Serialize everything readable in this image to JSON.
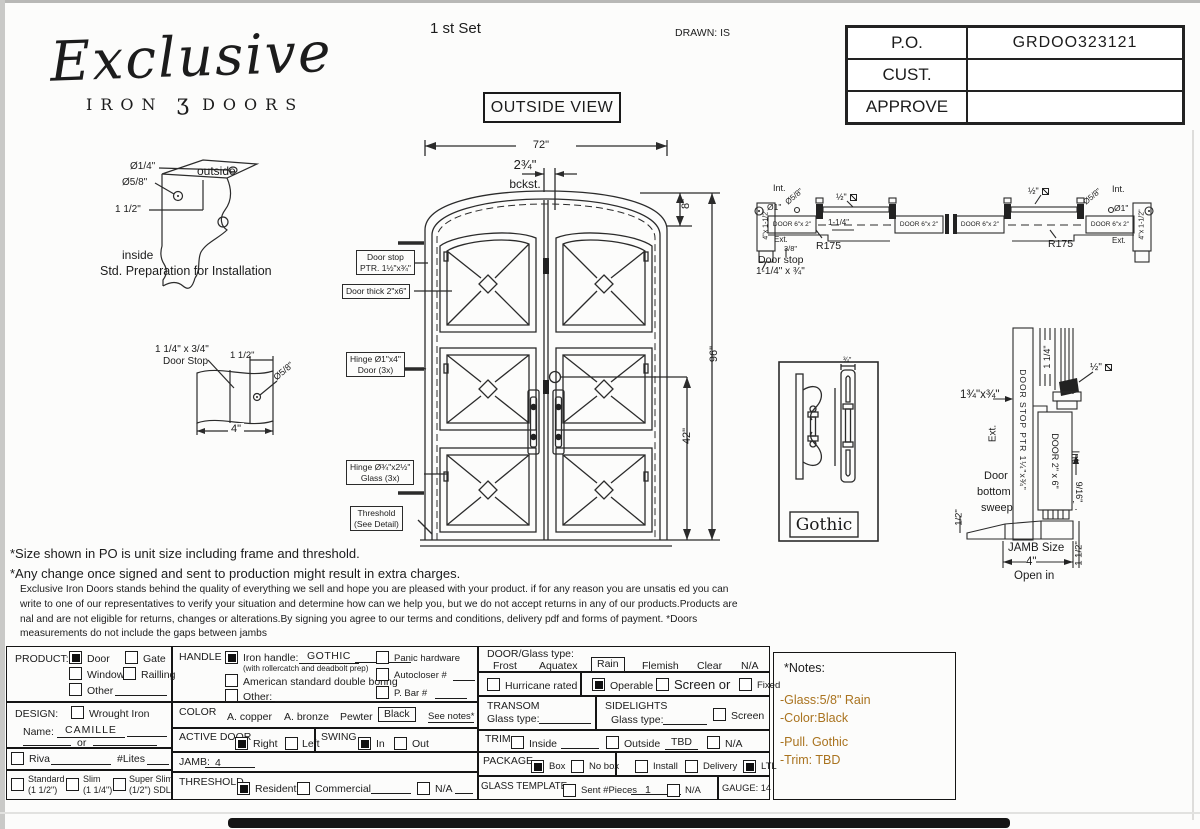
{
  "page": {
    "set_label": "1 st Set",
    "drawn_label": "DRAWN: IS",
    "outside_view": "OUTSIDE VIEW"
  },
  "logo": {
    "script": "Exclusive",
    "iron": "IRON",
    "amp": "ʒ",
    "doors": "DOORS"
  },
  "po_table": {
    "rows": [
      {
        "label": "P.O.",
        "value": "GRDOO323121"
      },
      {
        "label": "CUST.",
        "value": ""
      },
      {
        "label": "APPROVE",
        "value": ""
      }
    ]
  },
  "corner_detail": {
    "dia_quarter": "Ø1/4\"",
    "dia_fiveeighths": "Ø5/8\"",
    "dim_one_half": "1 1/2\"",
    "outside": "outside",
    "inside": "inside",
    "caption": "Std. Preparation for Installation"
  },
  "doorstop_detail": {
    "size": "1 1/4\" x 3/4\"",
    "name": "Door Stop",
    "dim_one_half": "1 1/2\"",
    "dia": "Ø5/8\"",
    "width": "4\""
  },
  "door": {
    "dim_width": "72\"",
    "backset": "2¾\"",
    "backset_sub": "bckst.",
    "dim_top": "8\"",
    "dim_height": "96\"",
    "dim_handle": "42\"",
    "lbl_stop_1": "Door stop",
    "lbl_stop_2": "PTR. 1½\"x¾\"",
    "lbl_thick": "Door thick 2\"x6\"",
    "lbl_hinge_door_1": "Hinge Ø1\"x4\"",
    "lbl_hinge_door_2": "Door (3x)",
    "lbl_hinge_glass_1": "Hinge Ø¾\"x2½\"",
    "lbl_hinge_glass_2": "Glass (3x)",
    "lbl_threshold_1": "Threshold",
    "lbl_threshold_2": "(See Detail)"
  },
  "plan": {
    "int_l": "Int.",
    "dia1_l": "Ø1\"",
    "dia58_l": "Ø5/8\"",
    "jamb_box": "4\"x 1-1/2\"",
    "door_box": "DOOR 6\"x 2\"",
    "half": "½\"",
    "dim_114": "1-1/4\"",
    "ext_l": "Ext.",
    "dim_38": "3/8\"",
    "r175": "R175",
    "stop_1": "Door stop",
    "stop_2": "1-1/4\" x ¾\"",
    "dia58_r": "Ø5/8\"",
    "int_r": "Int.",
    "dia1_r": "Ø1\"",
    "ext_r": "Ext."
  },
  "handle_box": {
    "caption": "Gothic",
    "dim": "¾\""
  },
  "jamb_section": {
    "dim_114": "1 1/4\"",
    "half": "½\"",
    "dim_134": "1¾\"x¾\"",
    "strip": "DOOR STOP PTR 1¼\"x¾\"",
    "ext": "Ext.",
    "door_box": "DOOR 2\" x 6\"",
    "int": "Int.",
    "dim_916": "9/16\"",
    "sweep_1": "Door",
    "sweep_2": "bottom",
    "sweep_3": "sweep",
    "dim_half": "1/2\"",
    "jamb_1": "JAMB Size",
    "jamb_2": "4\"",
    "jamb_3": "Open in",
    "dim_1half": "1 1/2\""
  },
  "disclaimer": {
    "line1": "*Size shown in PO is unit size including frame and threshold.",
    "line2": "*Any change once signed and sent to production might result in extra charges.",
    "body": "Exclusive Iron Doors stands behind the quality of everything we sell and hope you are pleased with your product. if for any reason you are unsatis ed you can write to one of our representatives to verify your situation and determine how can we help you, but we do not accept returns in any of our products.Products are nal and are not eligible for returns, changes or alterations.By signing you agree to our terms and conditions, delivery pdf and forms of payment. *Doors measurements do not include the gaps between jambs"
  },
  "form": {
    "product": {
      "label": "PRODUCT:",
      "door": "Door",
      "door_c": true,
      "gate": "Gate",
      "gate_c": false,
      "window": "Window",
      "window_c": false,
      "railing": "Railling",
      "railing_c": false,
      "other": "Other",
      "other_c": false
    },
    "handle": {
      "label": "HANDLE",
      "iron": "Iron handle:",
      "iron_val": "GOTHIC",
      "iron_c": true,
      "iron_sub": "(with rollercatch and deadbolt prep)",
      "american": "American standard double boring",
      "american_c": false,
      "other": "Other:",
      "other_c": false,
      "panic": "Panic hardware",
      "panic_c": false,
      "autocloser": "Autocloser #",
      "autocloser_c": false,
      "pbar": "P. Bar #",
      "pbar_c": false
    },
    "color": {
      "label": "COLOR",
      "copper": "A. copper",
      "bronze": "A. bronze",
      "pewter": "Pewter",
      "selected": "Black",
      "see_notes": "See notes*"
    },
    "design": {
      "label": "DESIGN:",
      "wrought": "Wrought Iron",
      "wrought_c": false,
      "name_label": "Name:",
      "name_value": "CAMILLE",
      "or": "or"
    },
    "riva": {
      "label": "Riva",
      "lites": "#Lites",
      "riva_c": false
    },
    "grid": {
      "standard": "Standard",
      "standard_sub": "(1 1/2\")",
      "standard_c": false,
      "slim": "Slim",
      "slim_sub": "(1 1/4\")",
      "slim_c": false,
      "super_slim": "Super Slim",
      "super_slim_sub": "(1/2\") SDL",
      "super_slim_c": false
    },
    "active": {
      "label": "ACTIVE DOOR",
      "right": "Right",
      "right_c": true,
      "left": "Left",
      "left_c": false
    },
    "swing": {
      "label": "SWING",
      "in_": "In",
      "in_c": true,
      "out": "Out",
      "out_c": false
    },
    "jamb": {
      "label": "JAMB:",
      "value": "4"
    },
    "threshold": {
      "label": "THRESHOLD",
      "residential": "Residential",
      "residential_c": true,
      "commercial": "Commercial",
      "commercial_c": false,
      "na": "N/A",
      "na_c": false
    },
    "glass": {
      "label": "DOOR/Glass type:",
      "frost": "Frost",
      "aquatex": "Aquatex",
      "selected": "Rain",
      "flemish": "Flemish",
      "clear": "Clear",
      "na": "N/A",
      "hurricane": "Hurricane rated",
      "hurricane_c": false,
      "operable": "Operable",
      "operable_c": true,
      "screen_or": "Screen or",
      "screen_c": false,
      "fixed": "Fixed",
      "fixed_c": false
    },
    "transom": {
      "label": "TRANSOM",
      "glass_type": "Glass type:"
    },
    "sidelights": {
      "label": "SIDELIGHTS",
      "glass_type": "Glass type:",
      "screen": "Screen",
      "screen_c": false
    },
    "trim": {
      "label": "TRIM",
      "inside": "Inside",
      "inside_c": false,
      "outside": "Outside",
      "outside_val": "TBD",
      "outside_c": false,
      "na": "N/A",
      "na_c": false
    },
    "package": {
      "label": "PACKAGE",
      "box": "Box",
      "box_c": true,
      "nobox": "No box",
      "nobox_c": false,
      "install": "Install",
      "install_c": false,
      "delivery": "Delivery",
      "delivery_c": false,
      "ltl": "LTL",
      "ltl_c": true
    },
    "template": {
      "label": "GLASS TEMPLATE",
      "sent": "Sent #Pieces",
      "sent_c": false,
      "pieces": "1",
      "na": "N/A",
      "na_c": false,
      "gauge": "GAUGE: 14"
    }
  },
  "notes": {
    "title": "*Notes:",
    "color": "#a9731f",
    "lines": [
      "-Glass:5/8\" Rain",
      "-Color:Black",
      "-Pull. Gothic",
      "-Trim: TBD"
    ]
  }
}
